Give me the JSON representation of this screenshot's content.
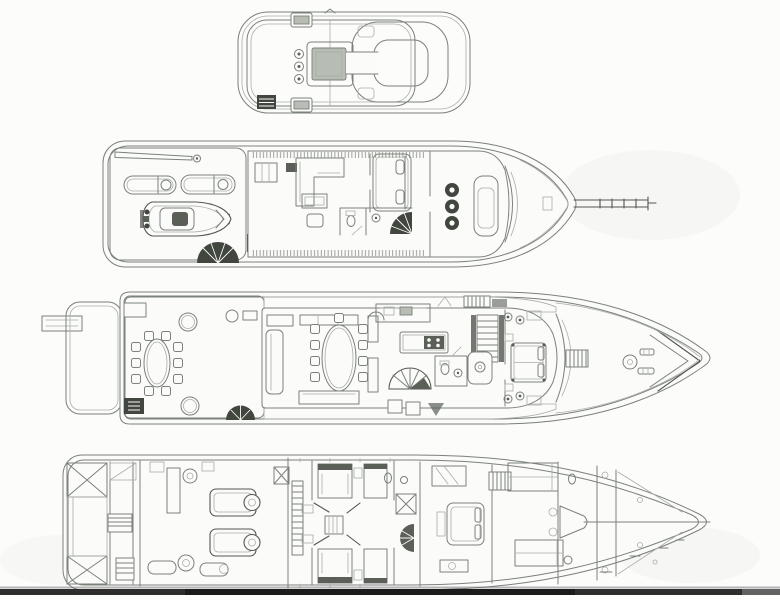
{
  "document": {
    "kind": "yacht-general-arrangement-plan",
    "aria_label": "Scanned line drawing of a motor yacht general arrangement plan with four stacked deck views: flybridge, bridge deck, main deck and lower deck",
    "views": [
      {
        "id": "flybridge",
        "features": [
          "helm-console",
          "pedestal-seats",
          "ring-seating",
          "deck-hatches",
          "companionway-hatch"
        ]
      },
      {
        "id": "bridge-deck",
        "features": [
          "davit-crane",
          "sun-loungers",
          "tender",
          "aft-deck-stairs",
          "skylounge-sofa",
          "captain-cabin-bed",
          "bathroom",
          "pilothouse-chairs",
          "helm-console",
          "bow-pole"
        ]
      },
      {
        "id": "main-deck",
        "features": [
          "passerelle",
          "swim-platform",
          "alfresco-dining-table",
          "round-side-tables",
          "salon-sofas",
          "formal-dining-table",
          "galley-island",
          "spiral-staircase",
          "day-head",
          "staircase",
          "master-bed",
          "foredeck-capstan",
          "bow-chevrons"
        ]
      },
      {
        "id": "lower-deck",
        "features": [
          "lazarette-tanks",
          "engine-pair",
          "generators",
          "twin-guest-cabins",
          "guest-bathrooms",
          "spiral-staircase",
          "vip-bed",
          "crew-bunks",
          "crew-mess",
          "forepeak"
        ]
      }
    ]
  },
  "colors": {
    "background": "#fcfcfb",
    "paper": "#fbfbfa",
    "line": "#7b817b",
    "line_dark": "#53584f",
    "line_faint": "#a9aea6",
    "teak": "#a3a99b",
    "teak_line": "#848b7e",
    "shade": "#b7bcb4",
    "dark": "#41463f",
    "dark2": "#5a5f57",
    "band": "#2d2d2d",
    "band_dark": "#1b1b1b",
    "band_light": "#6e6e6e"
  }
}
